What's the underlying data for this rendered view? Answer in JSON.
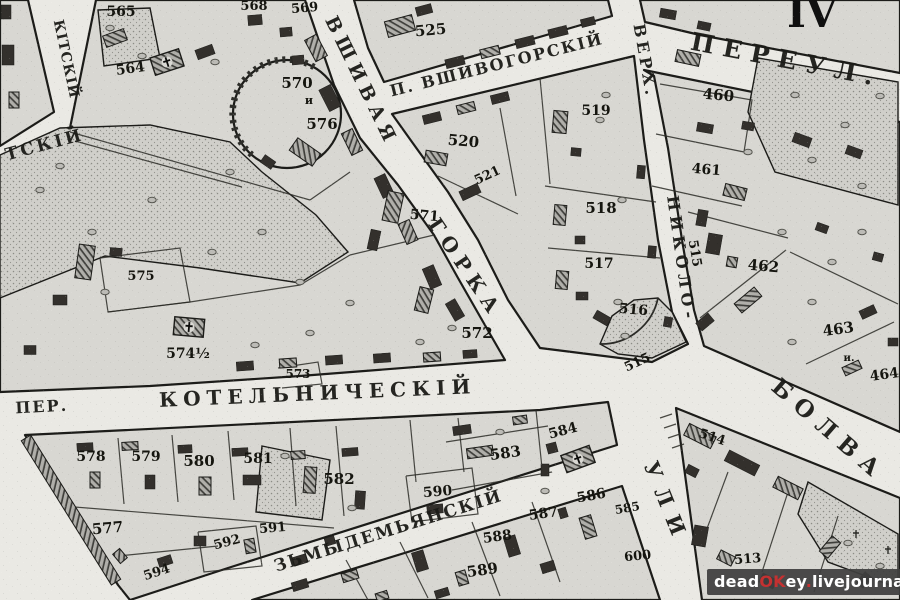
{
  "map": {
    "plate_number": "IV",
    "colors": {
      "paper": "#eae9e4",
      "block_fill": "#d8d7d2",
      "line_ink": "#1c1c19",
      "building_ink": "#33302c",
      "watermark_bg": "#3e3e3e",
      "watermark_accent": "#c53131",
      "watermark_text": "#ffffff"
    },
    "street_labels": [
      {
        "name": "street-vshivaya",
        "text": "ВШИВАЯ",
        "x": 356,
        "y": 84,
        "rotate": 64,
        "size": 19,
        "spacing": 6
      },
      {
        "name": "street-gorka",
        "text": "ГОРКА",
        "x": 460,
        "y": 272,
        "rotate": 56,
        "size": 20,
        "spacing": 7
      },
      {
        "name": "street-vshivogorsky",
        "text": "П. ВШИВОГОРСКІЙ",
        "x": 498,
        "y": 70,
        "rotate": -14,
        "size": 16,
        "spacing": 2
      },
      {
        "name": "street-pereul",
        "text": "ПЕРЕУЛ.",
        "x": 785,
        "y": 68,
        "rotate": 11,
        "size": 25,
        "spacing": 9
      },
      {
        "name": "street-verh",
        "text": "ВЕРХ.",
        "x": 640,
        "y": 62,
        "rotate": 80,
        "size": 16,
        "spacing": 4
      },
      {
        "name": "street-nikolo",
        "text": "НИКОЛО-",
        "x": 676,
        "y": 260,
        "rotate": 82,
        "size": 16,
        "spacing": 5
      },
      {
        "name": "street-bolva",
        "text": "БОЛВА",
        "x": 824,
        "y": 436,
        "rotate": 41,
        "size": 23,
        "spacing": 9
      },
      {
        "name": "street-ulitsa",
        "text": "УЛИ",
        "x": 660,
        "y": 506,
        "rotate": 68,
        "size": 21,
        "spacing": 11
      },
      {
        "name": "street-kotelnichesky",
        "text": "КОТЕЛЬНИЧЕСКІЙ",
        "x": 318,
        "y": 400,
        "rotate": -2.5,
        "size": 20,
        "spacing": 6
      },
      {
        "name": "street-per",
        "text": "ПЕР.",
        "x": 42,
        "y": 412,
        "rotate": -3,
        "size": 16,
        "spacing": 2
      },
      {
        "name": "street-kozmodemyansky",
        "text": "ЗЬМЫДЕМЬЯНСКІЙ",
        "x": 390,
        "y": 536,
        "rotate": -17.5,
        "size": 17,
        "spacing": 2
      },
      {
        "name": "street-nikitsky",
        "text": "КІТСКІЙ",
        "x": 62,
        "y": 60,
        "rotate": 78,
        "size": 14,
        "spacing": 1
      },
      {
        "name": "street-tsky",
        "text": "ТСКІЙ",
        "x": 46,
        "y": 150,
        "rotate": -15,
        "size": 17,
        "spacing": 3
      }
    ],
    "parcel_numbers": [
      {
        "text": "565",
        "x": 121,
        "y": 16,
        "rotate": 0,
        "size": 14
      },
      {
        "text": "564",
        "x": 131,
        "y": 73,
        "rotate": -8,
        "size": 14
      },
      {
        "text": "568",
        "x": 254,
        "y": 10,
        "rotate": 0,
        "size": 13
      },
      {
        "text": "569",
        "x": 305,
        "y": 12,
        "rotate": -5,
        "size": 13
      },
      {
        "text": "570",
        "x": 297,
        "y": 88,
        "rotate": 0,
        "size": 15
      },
      {
        "text": "и",
        "x": 309,
        "y": 104,
        "rotate": 0,
        "size": 11
      },
      {
        "text": "576",
        "x": 322,
        "y": 129,
        "rotate": 0,
        "size": 15
      },
      {
        "text": "525",
        "x": 431,
        "y": 35,
        "rotate": -5,
        "size": 15
      },
      {
        "text": "520",
        "x": 463,
        "y": 146,
        "rotate": 5,
        "size": 15
      },
      {
        "text": "521",
        "x": 489,
        "y": 179,
        "rotate": -25,
        "size": 13
      },
      {
        "text": "519",
        "x": 596,
        "y": 115,
        "rotate": 0,
        "size": 14
      },
      {
        "text": "518",
        "x": 601,
        "y": 213,
        "rotate": 0,
        "size": 15
      },
      {
        "text": "517",
        "x": 599,
        "y": 268,
        "rotate": 0,
        "size": 14
      },
      {
        "text": "516",
        "x": 633,
        "y": 314,
        "rotate": 5,
        "size": 14
      },
      {
        "text": "515",
        "x": 691,
        "y": 254,
        "rotate": 80,
        "size": 13
      },
      {
        "text": "515",
        "x": 639,
        "y": 366,
        "rotate": -25,
        "size": 13
      },
      {
        "text": "460",
        "x": 718,
        "y": 100,
        "rotate": 5,
        "size": 15
      },
      {
        "text": "461",
        "x": 706,
        "y": 174,
        "rotate": 5,
        "size": 14
      },
      {
        "text": "462",
        "x": 763,
        "y": 271,
        "rotate": 5,
        "size": 15
      },
      {
        "text": "463",
        "x": 839,
        "y": 334,
        "rotate": -8,
        "size": 15
      },
      {
        "text": "и.",
        "x": 849,
        "y": 361,
        "rotate": 0,
        "size": 10
      },
      {
        "text": "464",
        "x": 885,
        "y": 379,
        "rotate": -8,
        "size": 14
      },
      {
        "text": "571",
        "x": 424,
        "y": 220,
        "rotate": 5,
        "size": 14
      },
      {
        "text": "572",
        "x": 477,
        "y": 338,
        "rotate": 0,
        "size": 15
      },
      {
        "text": "573",
        "x": 298,
        "y": 378,
        "rotate": 0,
        "size": 12
      },
      {
        "text": "574½",
        "x": 188,
        "y": 358,
        "rotate": 0,
        "size": 14
      },
      {
        "text": "575",
        "x": 141,
        "y": 280,
        "rotate": 0,
        "size": 13
      },
      {
        "text": "577",
        "x": 108,
        "y": 533,
        "rotate": -5,
        "size": 15
      },
      {
        "text": "578",
        "x": 91,
        "y": 461,
        "rotate": 0,
        "size": 14
      },
      {
        "text": "579",
        "x": 146,
        "y": 461,
        "rotate": 0,
        "size": 14
      },
      {
        "text": "580",
        "x": 199,
        "y": 466,
        "rotate": 0,
        "size": 15
      },
      {
        "text": "581",
        "x": 258,
        "y": 463,
        "rotate": 0,
        "size": 14
      },
      {
        "text": "582",
        "x": 339,
        "y": 484,
        "rotate": 0,
        "size": 15
      },
      {
        "text": "583",
        "x": 506,
        "y": 458,
        "rotate": -8,
        "size": 15
      },
      {
        "text": "584",
        "x": 564,
        "y": 435,
        "rotate": -15,
        "size": 14
      },
      {
        "text": "585",
        "x": 628,
        "y": 512,
        "rotate": -10,
        "size": 12
      },
      {
        "text": "586",
        "x": 592,
        "y": 500,
        "rotate": -10,
        "size": 14
      },
      {
        "text": "587",
        "x": 544,
        "y": 518,
        "rotate": -8,
        "size": 14
      },
      {
        "text": "588",
        "x": 498,
        "y": 541,
        "rotate": -8,
        "size": 14
      },
      {
        "text": "589",
        "x": 483,
        "y": 575,
        "rotate": -8,
        "size": 15
      },
      {
        "text": "590",
        "x": 438,
        "y": 496,
        "rotate": -5,
        "size": 14
      },
      {
        "text": "591",
        "x": 273,
        "y": 532,
        "rotate": -5,
        "size": 13
      },
      {
        "text": "592",
        "x": 228,
        "y": 546,
        "rotate": -15,
        "size": 13
      },
      {
        "text": "594",
        "x": 158,
        "y": 576,
        "rotate": -18,
        "size": 13
      },
      {
        "text": "600",
        "x": 638,
        "y": 560,
        "rotate": -5,
        "size": 13
      },
      {
        "text": "513",
        "x": 748,
        "y": 563,
        "rotate": -5,
        "size": 13
      },
      {
        "text": "514",
        "x": 711,
        "y": 441,
        "rotate": 18,
        "size": 13
      }
    ]
  },
  "watermark": {
    "segments": [
      {
        "text": "dead",
        "color": "#ffffff"
      },
      {
        "text": "OK",
        "color": "#c53131"
      },
      {
        "text": "ey",
        "color": "#ffffff"
      },
      {
        "text": ".",
        "color": "#c53131"
      },
      {
        "text": "livejournal",
        "color": "#ffffff"
      },
      {
        "text": ".",
        "color": "#c53131"
      },
      {
        "text": "com",
        "color": "#ffffff"
      }
    ]
  }
}
